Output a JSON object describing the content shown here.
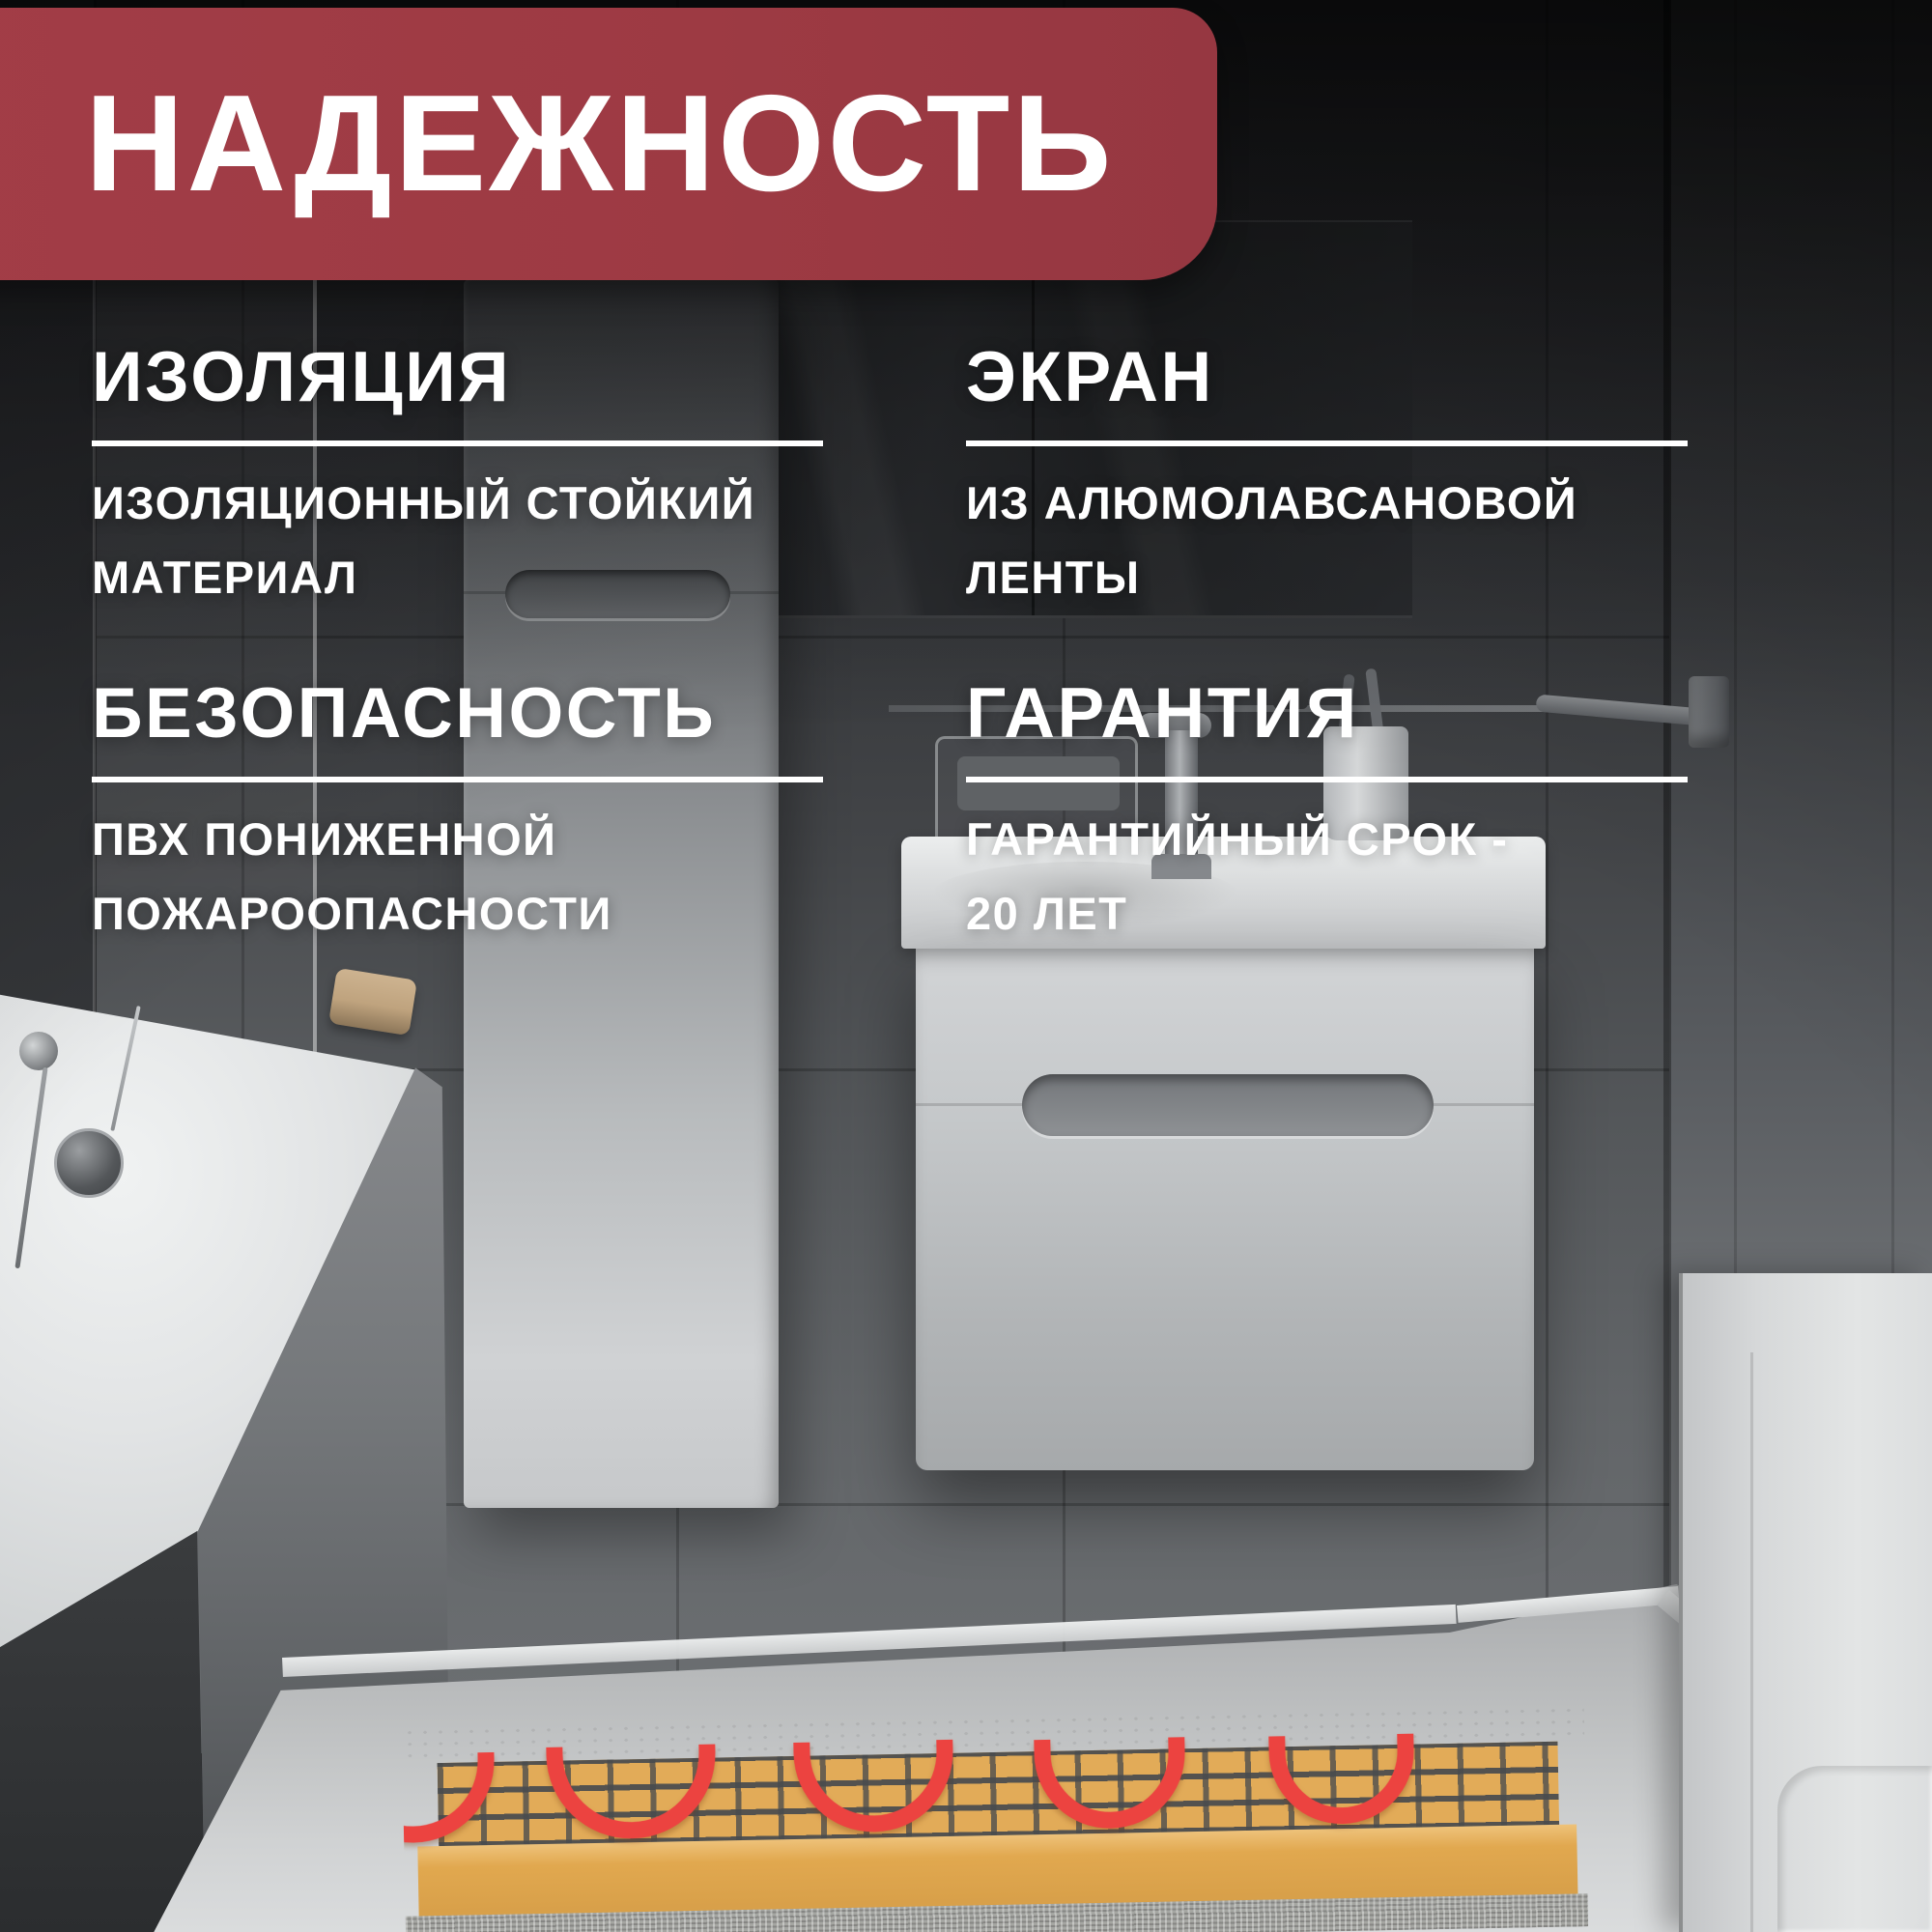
{
  "banner": {
    "title": "НАДЕЖНОСТЬ"
  },
  "features": [
    {
      "heading": "ИЗОЛЯЦИЯ",
      "lines": [
        "ИЗОЛЯЦИОННЫЙ СТОЙКИЙ",
        "МАТЕРИАЛ"
      ]
    },
    {
      "heading": "ЭКРАН",
      "lines": [
        "ИЗ АЛЮМОЛАВСАНОВОЙ",
        "ЛЕНТЫ"
      ]
    },
    {
      "heading": "БЕЗОПАСНОСТЬ",
      "lines": [
        "ПВХ ПОНИЖЕННОЙ",
        "ПОЖАРООПАСНОСТИ"
      ]
    },
    {
      "heading": "ГАРАНТИЯ",
      "lines": [
        "ГАРАНТИЙНЫЙ СРОК -",
        "20 ЛЕТ"
      ]
    }
  ],
  "colors": {
    "banner_red": "#9d3a43",
    "text_white": "#ffffff",
    "heating_cable_red": "#ec4340",
    "mat_adhesive_tan": "#e2ab58"
  },
  "scene": {
    "type": "bathroom-photo-background",
    "objects": [
      "bathtub",
      "shower-glass",
      "tall-cabinet",
      "mirror-cabinet",
      "vanity-with-sink",
      "faucet",
      "toothbrush-cup",
      "soap-rack",
      "towel-bar",
      "door",
      "heated-floor-cutaway-with-mesh-and-cable"
    ]
  }
}
